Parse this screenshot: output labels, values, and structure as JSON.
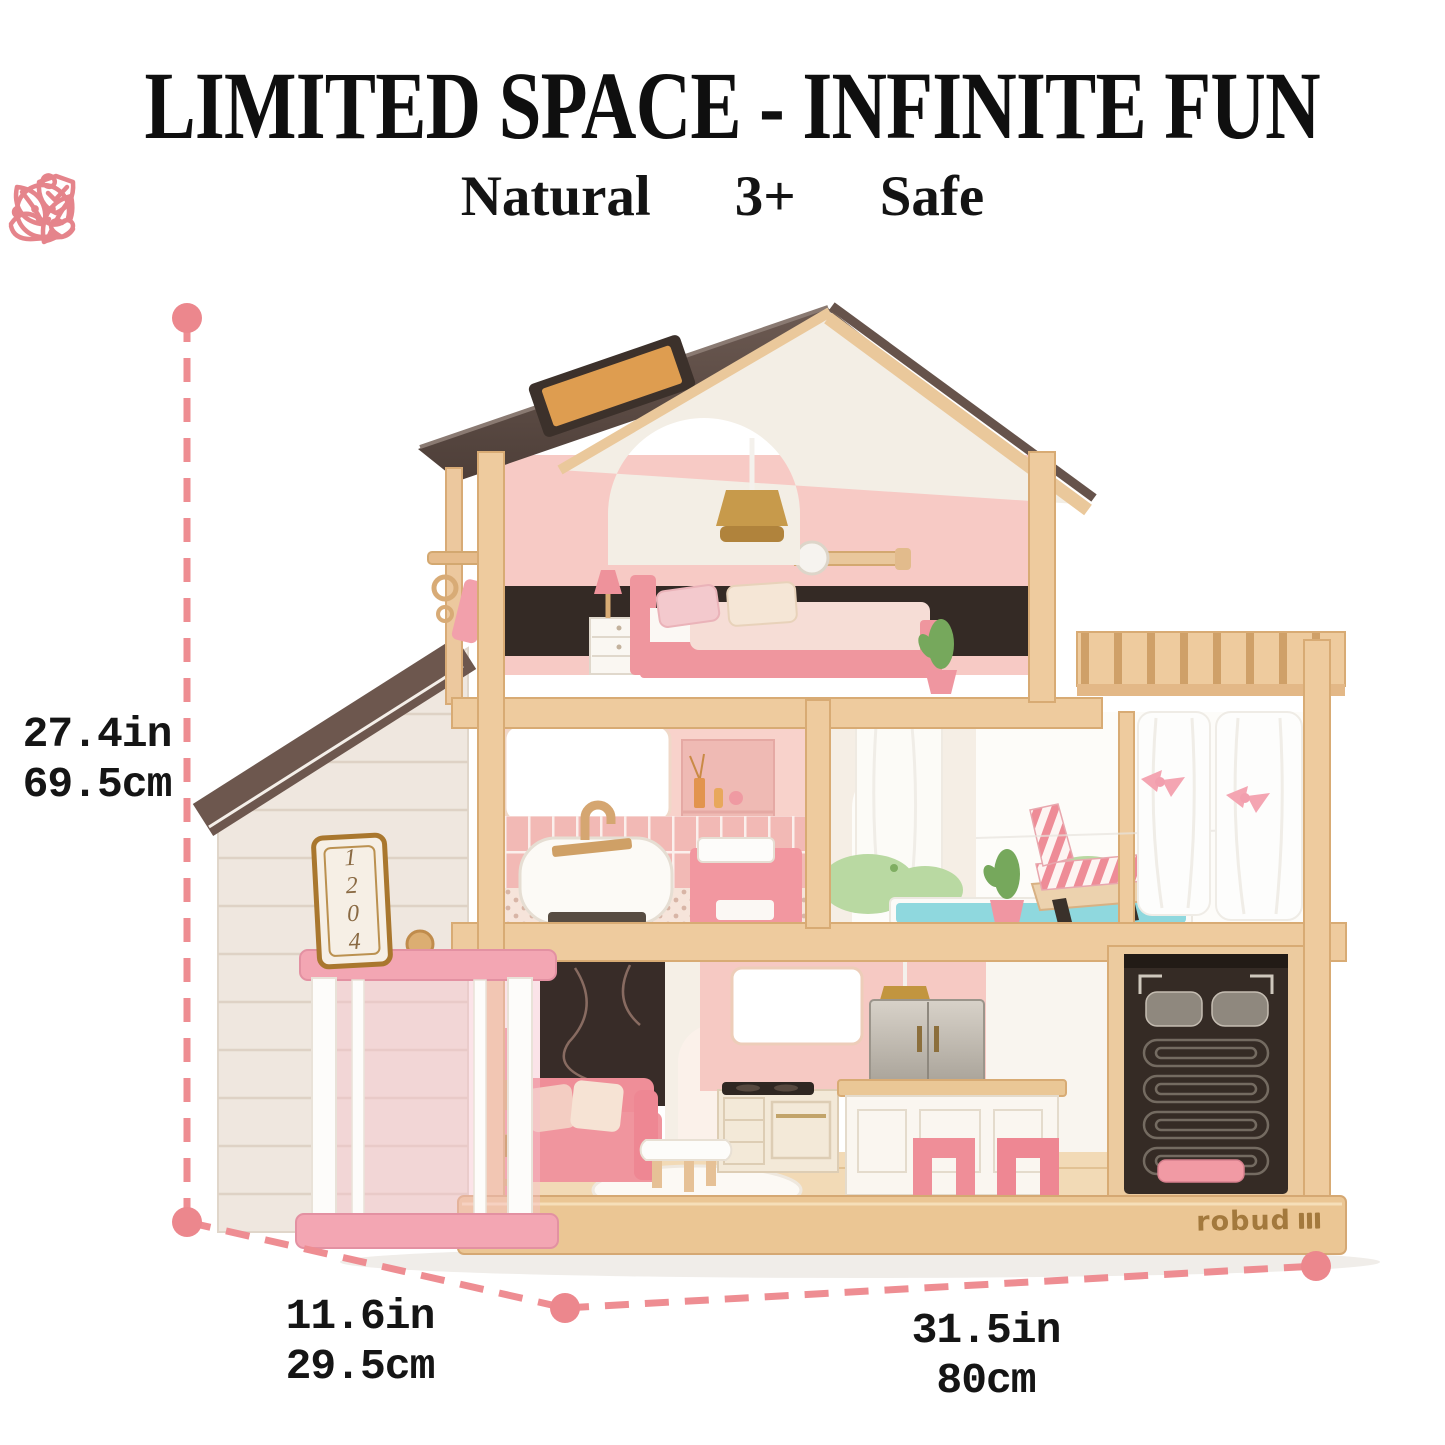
{
  "title": "LIMITED SPACE - INFINITE FUN",
  "features": [
    {
      "id": "natural",
      "icon": "leaf-icon",
      "label": "Natural"
    },
    {
      "id": "age",
      "icon": "baby-icon",
      "label": "3+"
    },
    {
      "id": "safe",
      "icon": "shield-hand-icon",
      "label": "Safe"
    }
  ],
  "dimensions": {
    "height": {
      "inches": "27.4in",
      "centimeters": "69.5cm"
    },
    "depth": {
      "inches": "11.6in",
      "centimeters": "29.5cm"
    },
    "width": {
      "inches": "31.5in",
      "centimeters": "80cm"
    }
  },
  "product": {
    "address_sign": "1204",
    "brand": "robud"
  },
  "colors": {
    "accent_pink": "#ED8B90",
    "icon_pink": "#E5848B",
    "text_black": "#141414",
    "roof_brown": "#5D4B44",
    "wood_light": "#EECB9E",
    "furniture_pink": "#EE8F98",
    "pool_teal": "#8FD8DE"
  }
}
